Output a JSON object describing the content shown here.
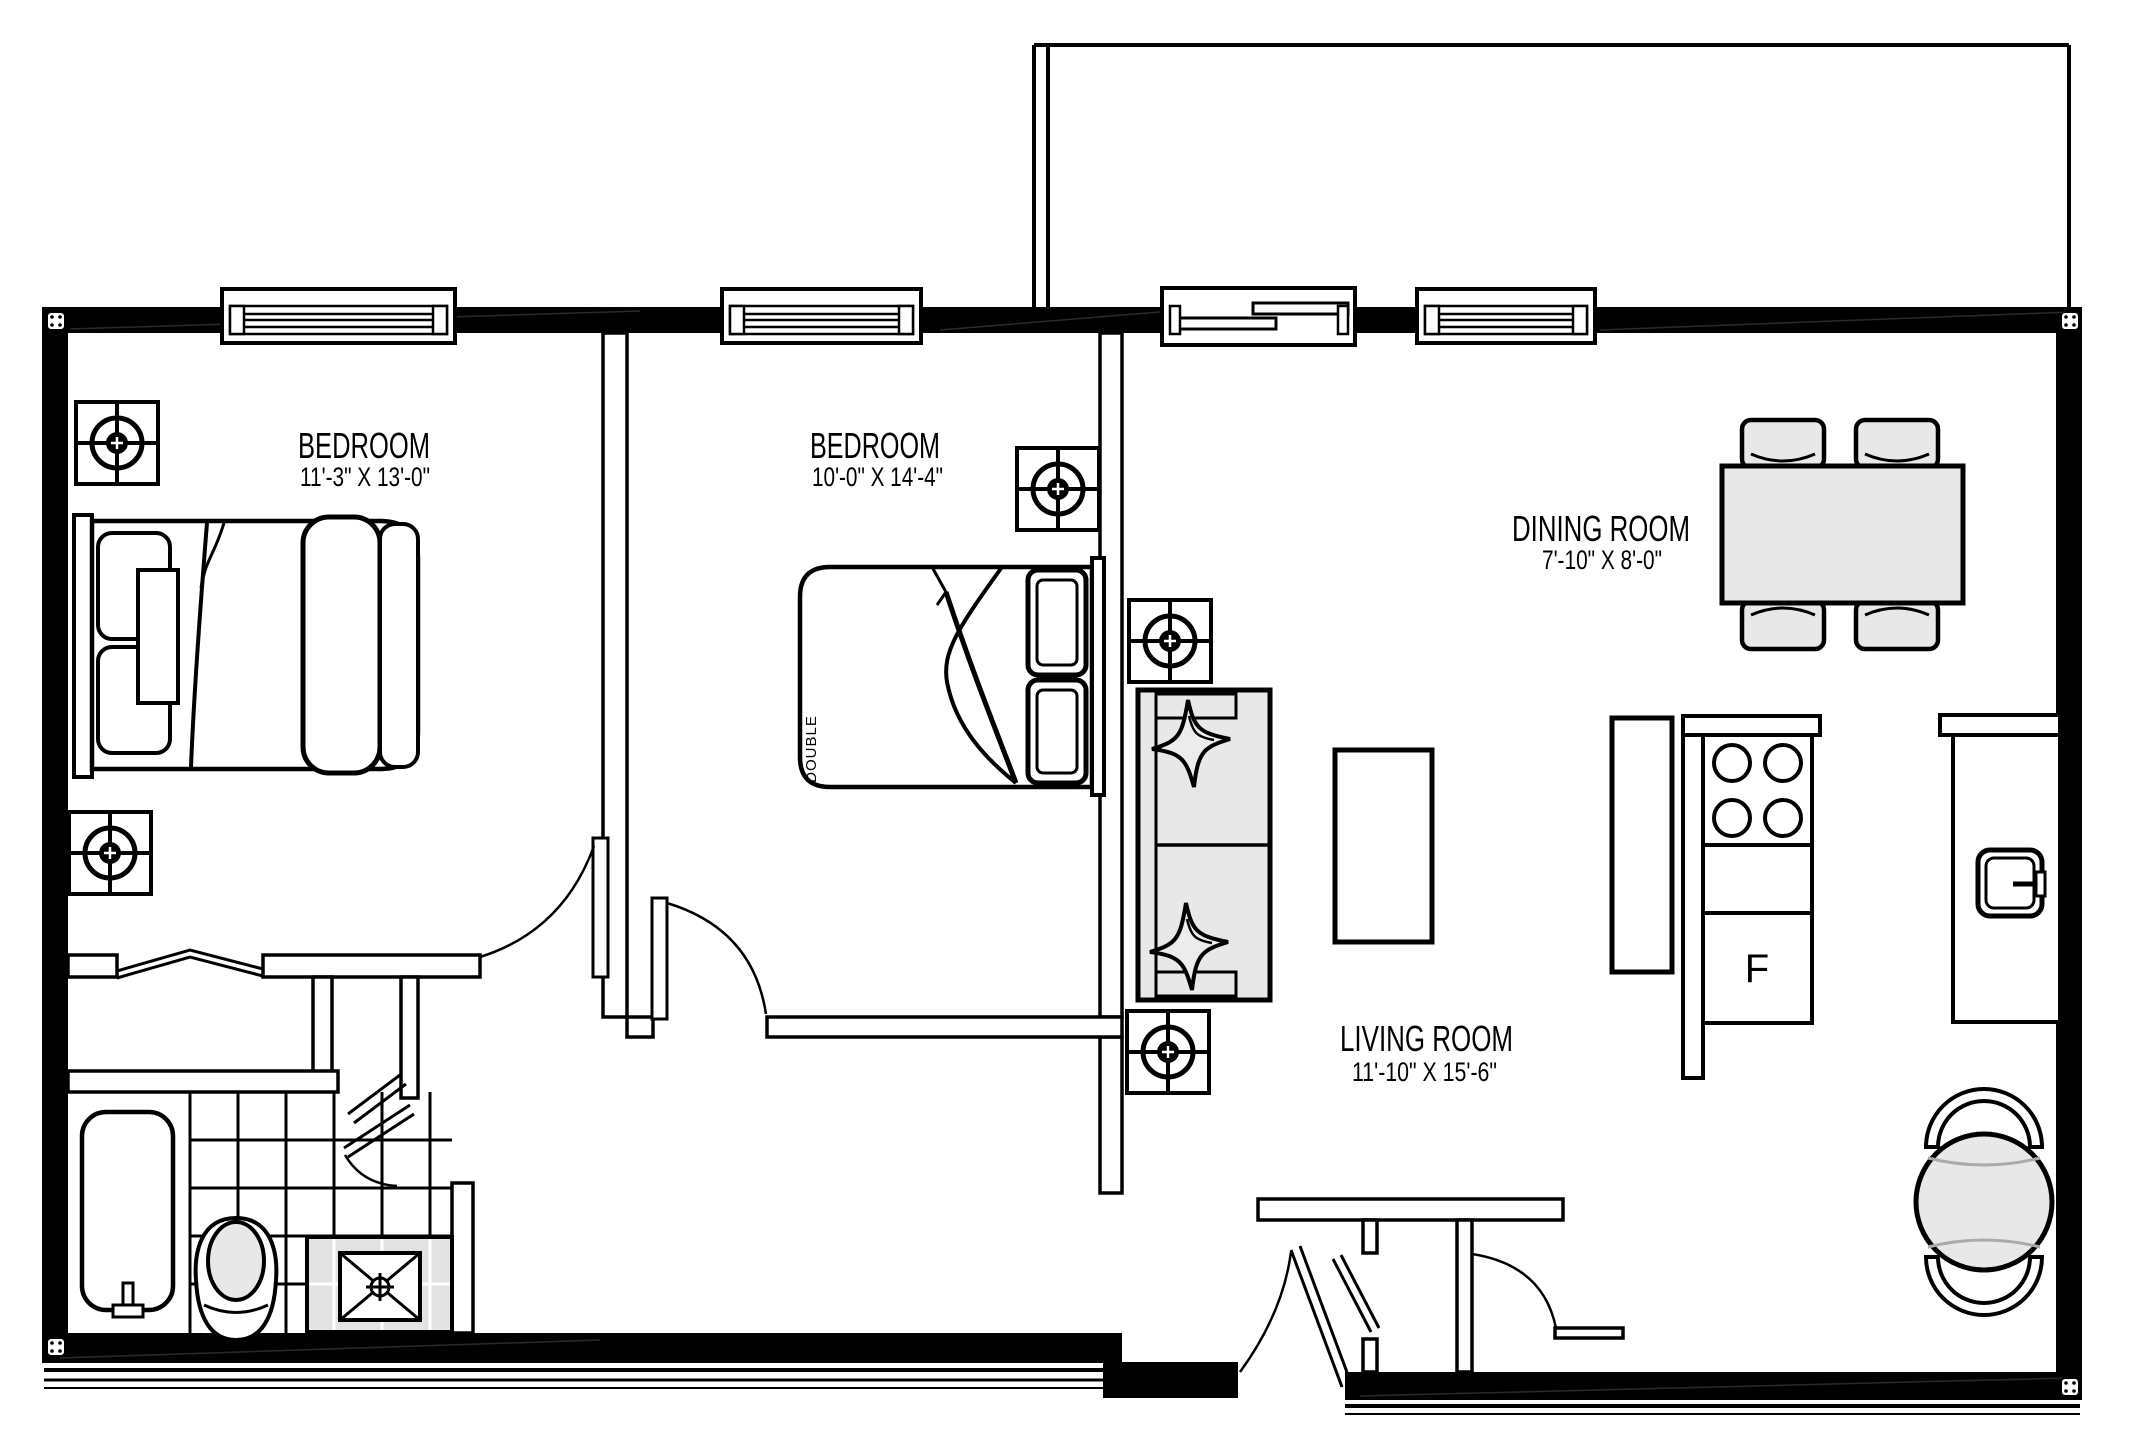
{
  "rooms": {
    "bedroom1": {
      "name": "BEDROOM",
      "dims": "11'-3\" X 13'-0\""
    },
    "bedroom2": {
      "name": "BEDROOM",
      "dims": "10'-0\" X 14'-4\""
    },
    "dining": {
      "name": "DINING ROOM",
      "dims": "7'-10\" X 8'-0\""
    },
    "living": {
      "name": "LIVING ROOM",
      "dims": "11'-10\" X 15'-6\""
    }
  },
  "furniture_labels": {
    "double_bed": "DOUBLE",
    "fridge": "F"
  },
  "colors": {
    "walls": "#000000",
    "furniture_fill": "#e8e8e8",
    "background": "#ffffff",
    "lines": "#000000"
  }
}
